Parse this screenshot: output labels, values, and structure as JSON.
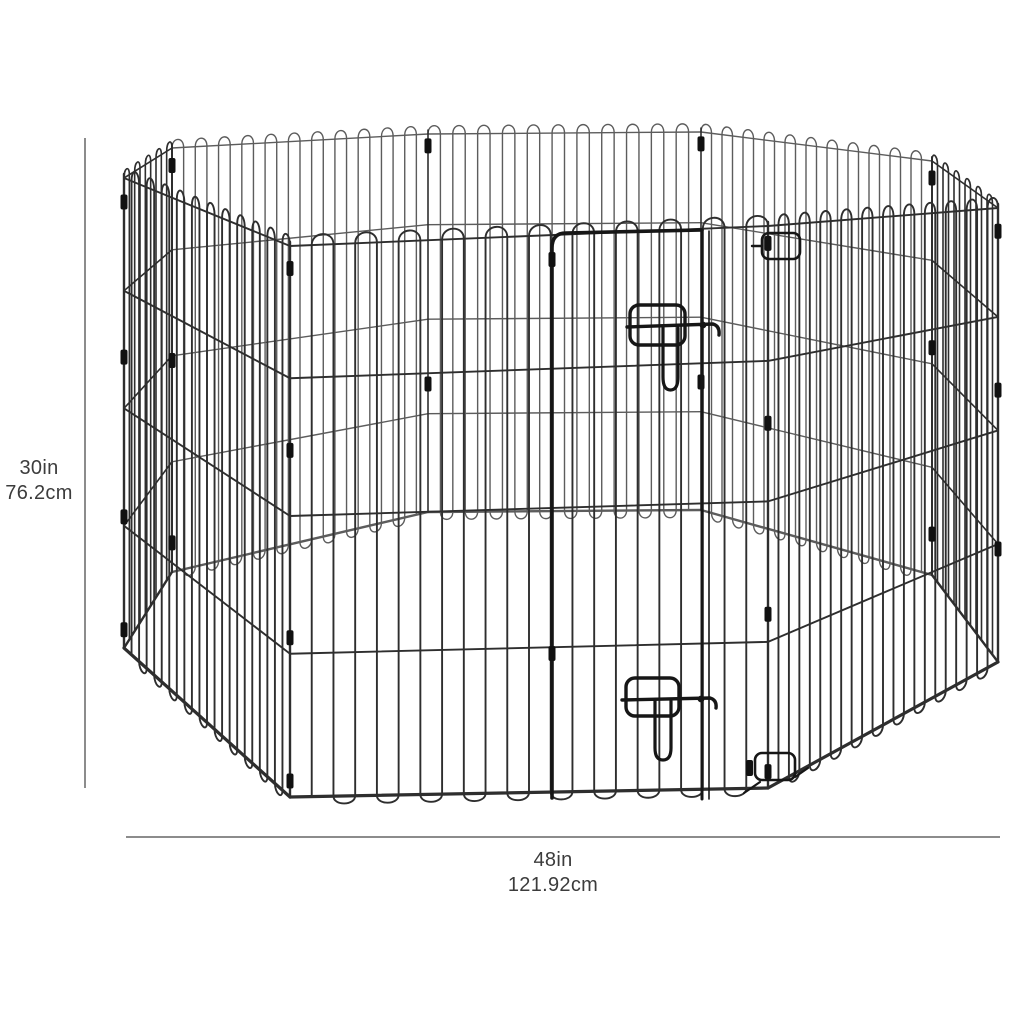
{
  "diagram": {
    "subject": "octagonal-wire-pet-exercise-pen",
    "height_dimension": {
      "inches": "30in",
      "centimeters": "76.2cm"
    },
    "width_dimension": {
      "inches": "48in",
      "centimeters": "121.92cm"
    },
    "colors": {
      "background": "#ffffff",
      "wire": "#2e2e2e",
      "wire_far": "#5c5c5c",
      "hardware": "#161616",
      "clip": "#111111",
      "dimension_line": "#8c8c8c",
      "label_text": "#3c3c3c"
    }
  }
}
